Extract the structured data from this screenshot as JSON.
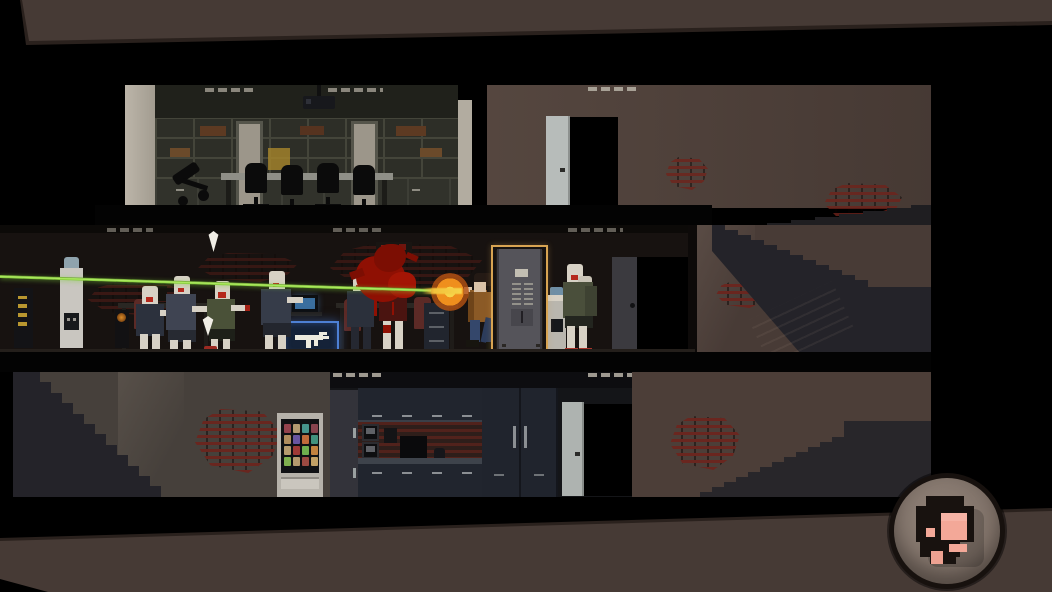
{
  "theme": {
    "bg": "#000000",
    "band": "#463a35",
    "band_edge": "#2a211d",
    "wall": "#4c3e38",
    "wall_mid": "#483b36",
    "wall_bottom": "#46403b",
    "office": "#26261f",
    "room_dark": "#171210",
    "kitchen": "#141518",
    "slab": "#030303",
    "stairs": "#242329",
    "beige": "#b2aca0",
    "door_light": "#b7bcba",
    "brick": "#70231c",
    "laser": "#8ed83d",
    "flash": "#ef8f1d",
    "blood": "#8f1003",
    "gold": "#d8a452",
    "crate": "#152238",
    "crate_glow": "#4d80d4",
    "skin": "#d7d1c5",
    "mouth": "#b5281c",
    "player_jacket": "#8b5a26",
    "jeans": "#34476b",
    "vent": "#b7b2a6",
    "cabinet": "#21252e",
    "chair_red": "#5c2a26",
    "avatar_ring": "#17110e",
    "avatar_bg": "#85776e",
    "avatar_skin": "#f3a898",
    "avatar_hair": "#18120f"
  },
  "hud": {
    "avatar_button": {
      "icon": "pixel-survivor-portrait",
      "ring_color": "#17110e",
      "face_colors": [
        "#18120f",
        "#f3a898",
        "#eda191"
      ]
    }
  },
  "scene": {
    "floors": [
      {
        "id": "top-floor",
        "objects": [
          "bookshelf-wall",
          "conference-table",
          "office-chairs",
          "fallen-office-chair",
          "ceiling-projector",
          "ceiling-vents",
          "interior-doors",
          "open-door",
          "dark-doorway",
          "exposed-bricks",
          "staircase"
        ]
      },
      {
        "id": "middle-floor",
        "objects": [
          "office-desks",
          "computer-monitors",
          "red-office-chairs",
          "file-cabinet",
          "snack-machine",
          "water-coolers",
          "smg-supply-crate",
          "elevator",
          "open-doorway",
          "exposed-bricks",
          "staircase"
        ]
      },
      {
        "id": "bottom-floor",
        "objects": [
          "vending-machine",
          "kitchen-cabinets",
          "wall-ovens",
          "counter",
          "fridge",
          "open-door",
          "dark-doorway",
          "exposed-bricks",
          "staircases"
        ]
      }
    ],
    "entities": {
      "player": {
        "pose": "firing-left",
        "weapon": "pistol",
        "effects": [
          "green-laser-sight",
          "muzzle-flash"
        ]
      },
      "zombies": [
        {
          "id": 1,
          "shirt": "#2c313d",
          "shoes": "barefoot"
        },
        {
          "id": 2,
          "shirt": "#3f4452",
          "shoes": "#c8c4b8"
        },
        {
          "id": 3,
          "shirt": "#4a5138",
          "shoes": "#a8352c"
        },
        {
          "id": 4,
          "shirt": "#363c49",
          "shoes": "#19181b"
        },
        {
          "id": 5,
          "shirt": "#2b303b",
          "shoes": "barefoot"
        },
        {
          "id": 6,
          "shirt": "#4a1410",
          "state": "being-shot-blood-splatter"
        },
        {
          "id": 7,
          "shirt": "#4a4f3b",
          "shoes": "#a8352c"
        },
        {
          "id": 8,
          "shirt": "#3e4232",
          "shoes": "#a8352c"
        }
      ],
      "markers": {
        "type": "down-arrow",
        "count": 2,
        "color": "#f0ede5"
      }
    },
    "elevator": {
      "highlight": "gold-outline",
      "panel": "call-button-grid",
      "icon": "elevator"
    },
    "supply_crate": {
      "icon": "uzi-icon",
      "highlight": "blue-glow"
    },
    "vending_machine": {
      "items": [
        "#93424d",
        "#b49a71",
        "#46948c",
        "#87434e",
        "#b08d5e",
        "#6a55a0",
        "#bf6a3a",
        "#42917e",
        "#b59a6e",
        "#a03a36",
        "#6fae4e",
        "#c2823f",
        "#7fb04f",
        "#b59a6e",
        "#9c4a42",
        "#c2a065"
      ]
    }
  }
}
